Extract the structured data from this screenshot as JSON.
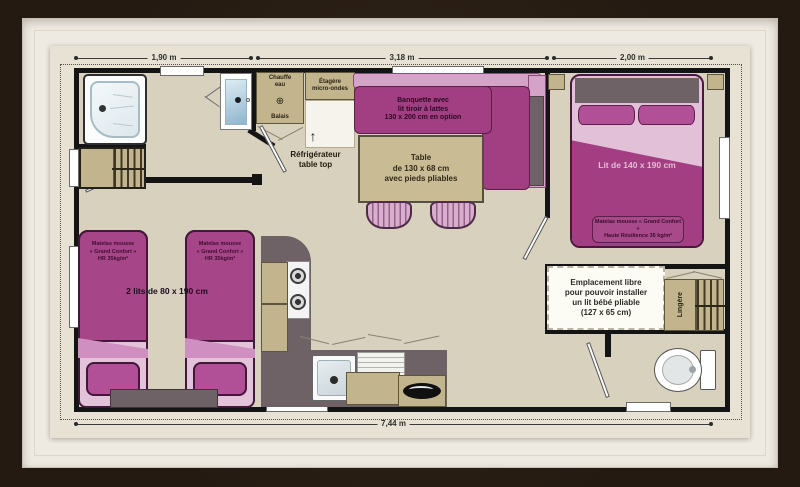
{
  "plan": {
    "dimensions": {
      "top": [
        "1,90 m",
        "3,18 m",
        "2,00 m"
      ],
      "bottom": "7,44 m"
    },
    "labels": {
      "water_heater": "Chauffe\neau",
      "broom": "Balais",
      "microwave_shelf": "Étagère\nmicro-ondes",
      "fridge": "Réfrigérateur\ntable top",
      "bench": "Banquette avec\nlit tiroir à lattes\n130 x 200 cm en option",
      "table": "Table\nde 130 x 68 cm\navec pieds pliables",
      "double_bed": "Lit de 140 x 190 cm",
      "double_bed_mattress": "Matelas mousse « Grand Confort »\nHaute Résilience 35 kg/m²",
      "twin_beds": "2 lits de 80 x 190 cm",
      "twin_bed_mattress": "Matelas mousse\n« Grand Confort »\nHR 35kg/m²",
      "baby_bed_space": "Emplacement libre\npour pouvoir installer\nun lit bébé pliable\n(127 x 65 cm)",
      "linen_closet": "Lingère"
    },
    "icons": {
      "arrow_up": "↑",
      "heater_vent": "⊕"
    },
    "palette": {
      "frame_brown": "#241a11",
      "mat_cream": "#efeae1",
      "paper": "#e7e2d3",
      "floor": "#d7d1bd",
      "wall": "#141414",
      "purple_dark": "#a23f82",
      "purple_mattress": "#a64587",
      "pink_light": "#d5a2c8",
      "tan": "#c2b48d",
      "counter_grey": "#6f6266"
    }
  }
}
